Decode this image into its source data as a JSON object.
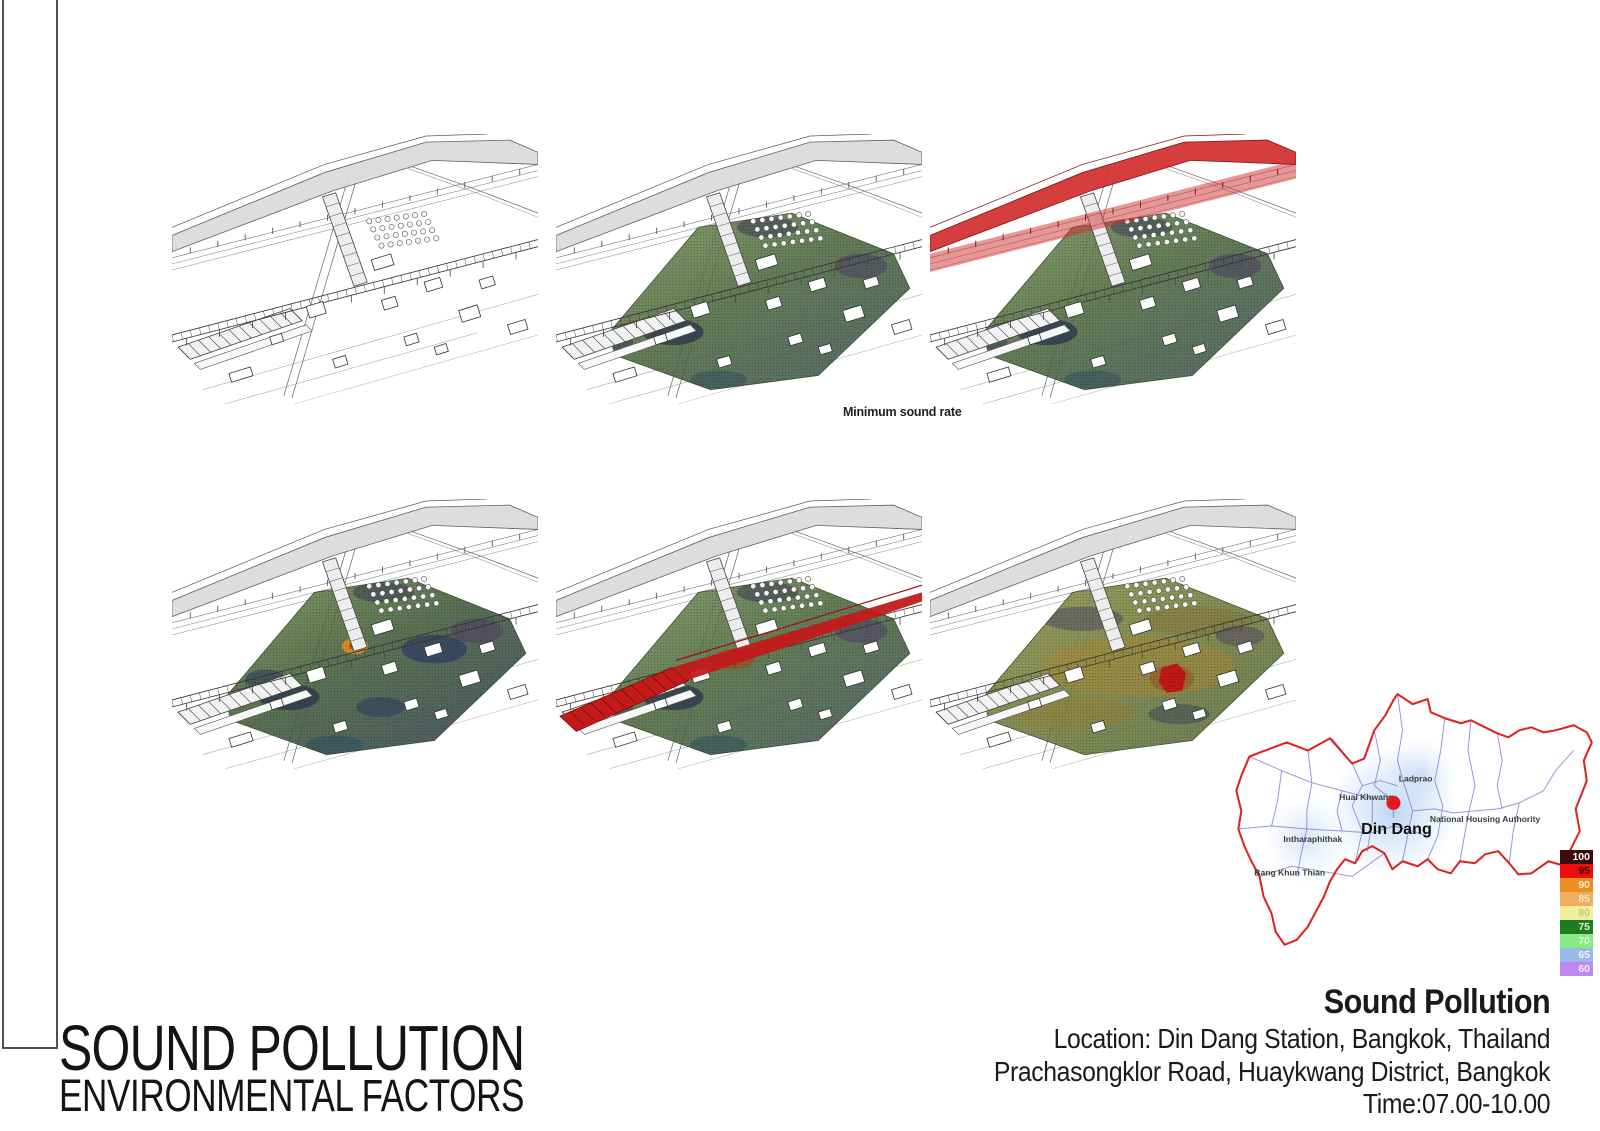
{
  "page": {
    "background": "#ffffff"
  },
  "panels": [
    {
      "name": "site-drawing-baseline",
      "row": 1,
      "col": 1,
      "mesh": false,
      "red_highway": false,
      "red_rail": false,
      "hotspot": "none",
      "tone": "none"
    },
    {
      "name": "site-drawing-minimum-sound",
      "row": 1,
      "col": 2,
      "mesh": true,
      "red_highway": false,
      "red_rail": false,
      "hotspot": "none",
      "tone": "green"
    },
    {
      "name": "site-drawing-expressway-noise",
      "row": 1,
      "col": 3,
      "mesh": true,
      "red_highway": true,
      "red_rail": false,
      "hotspot": "none",
      "tone": "green"
    },
    {
      "name": "site-drawing-ambient-noise",
      "row": 2,
      "col": 1,
      "mesh": true,
      "red_highway": false,
      "red_rail": false,
      "hotspot": "orange",
      "tone": "green-dark"
    },
    {
      "name": "site-drawing-railway-noise",
      "row": 2,
      "col": 2,
      "mesh": true,
      "red_highway": false,
      "red_rail": true,
      "hotspot": "none",
      "tone": "green"
    },
    {
      "name": "site-drawing-peak-noise",
      "row": 2,
      "col": 3,
      "mesh": true,
      "red_highway": false,
      "red_rail": false,
      "hotspot": "red",
      "tone": "warm"
    }
  ],
  "caption": {
    "text": "Minimum sound rate"
  },
  "map": {
    "outline_color": "#e02020",
    "district_line_color": "#8585d6",
    "glow_color": "#a9c9ee",
    "marker": {
      "label": "Din Dang",
      "color": "#e31b1b",
      "x": 186,
      "y": 131,
      "label_x": 189,
      "label_y": 147
    },
    "labels": [
      {
        "text": "Ladprao",
        "x": 208,
        "y": 95
      },
      {
        "text": "Huai Khwang",
        "x": 159,
        "y": 113
      },
      {
        "text": "National Housing Authority",
        "x": 277,
        "y": 135
      },
      {
        "text": "Intharaphithak",
        "x": 106,
        "y": 155
      },
      {
        "text": "Bang Khun Thian",
        "x": 83,
        "y": 188
      }
    ]
  },
  "legend": {
    "items": [
      {
        "value": "100",
        "color": "#3a0c0c",
        "text": "#ffffff"
      },
      {
        "value": "95",
        "color": "#ee0e0e",
        "text": "#4a0505"
      },
      {
        "value": "90",
        "color": "#e88f1f",
        "text": "#fdeccc"
      },
      {
        "value": "85",
        "color": "#efad62",
        "text": "#fbe3c4"
      },
      {
        "value": "80",
        "color": "#f1ef9d",
        "text": "#c9c385"
      },
      {
        "value": "75",
        "color": "#1f7d20",
        "text": "#d8f0c8"
      },
      {
        "value": "70",
        "color": "#88ea85",
        "text": "#e6fbde"
      },
      {
        "value": "65",
        "color": "#9ab9e9",
        "text": "#f0f5fd"
      },
      {
        "value": "60",
        "color": "#bd88f0",
        "text": "#f5ecfd"
      }
    ]
  },
  "info_block": {
    "title": "Sound Pollution",
    "line2": "Location: Din Dang Station, Bangkok, Thailand",
    "line3": "Prachasongklor Road, Huaykwang District, Bangkok",
    "line4": "Time:07.00-10.00"
  },
  "title_block": {
    "line1": "SOUND POLLUTION",
    "line2": "ENVIRONMENTAL FACTORS"
  }
}
